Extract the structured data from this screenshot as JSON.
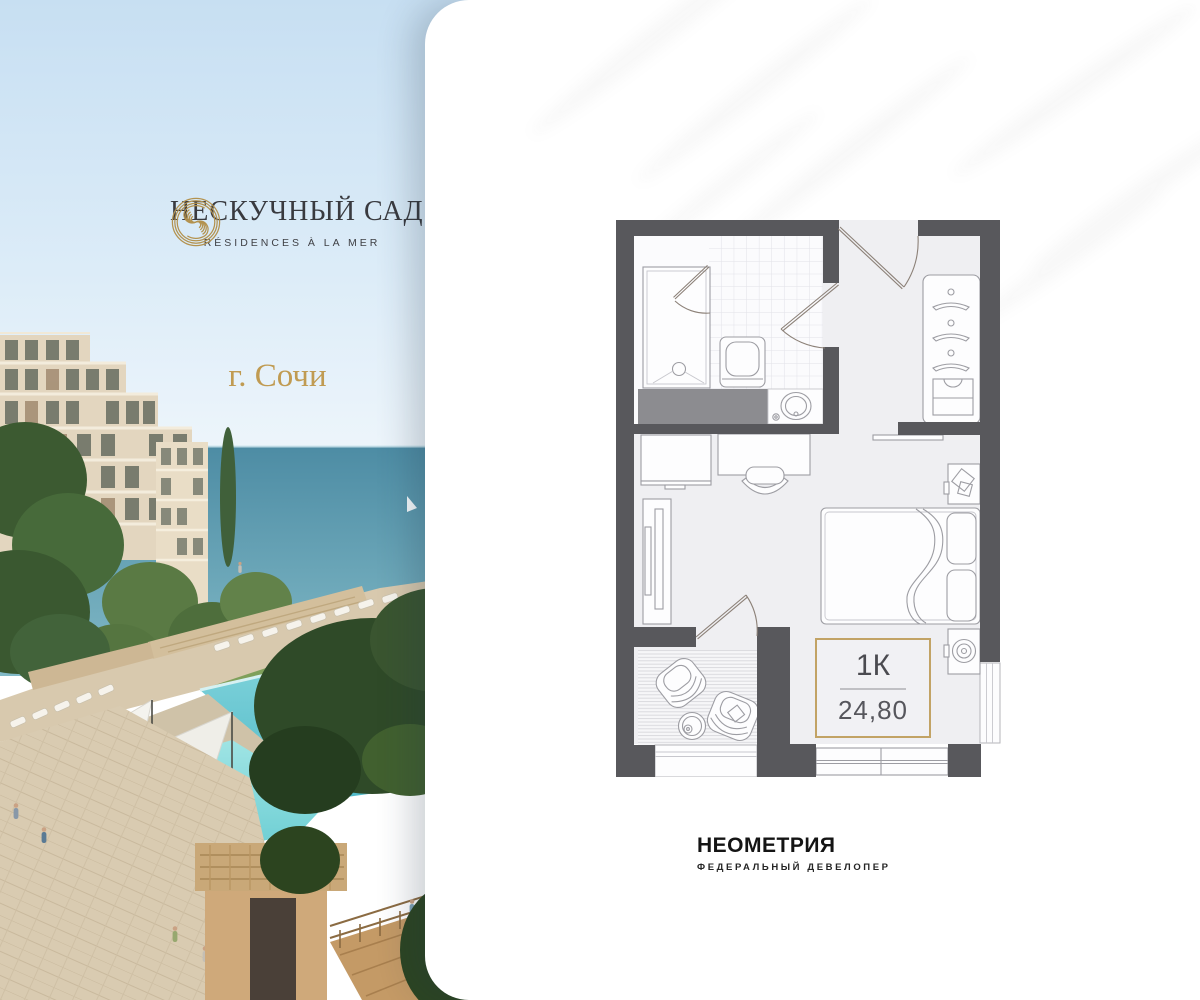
{
  "brand": {
    "name": "НЕСКУЧНЫЙ САД",
    "tagline": "RÉSIDENCES À LA MER",
    "city": "г. Сочи",
    "logo_icon": "spiral-monogram-icon",
    "gold": "#b3924f",
    "text_dark": "#3a3b40"
  },
  "plan": {
    "type": "1К",
    "area": "24,80",
    "accent_gold": "#c2a365",
    "wall_gray": "#58585c"
  },
  "developer": {
    "name": "НЕОМЕТРИЯ",
    "subtitle": "ФЕДЕРАЛЬНЫЙ ДЕВЕЛОПЕР",
    "color": "#141414"
  },
  "icons": {
    "brand_mark": "spiral-monogram-icon",
    "card_watermark": "palm-leaf-watermark-icon"
  }
}
